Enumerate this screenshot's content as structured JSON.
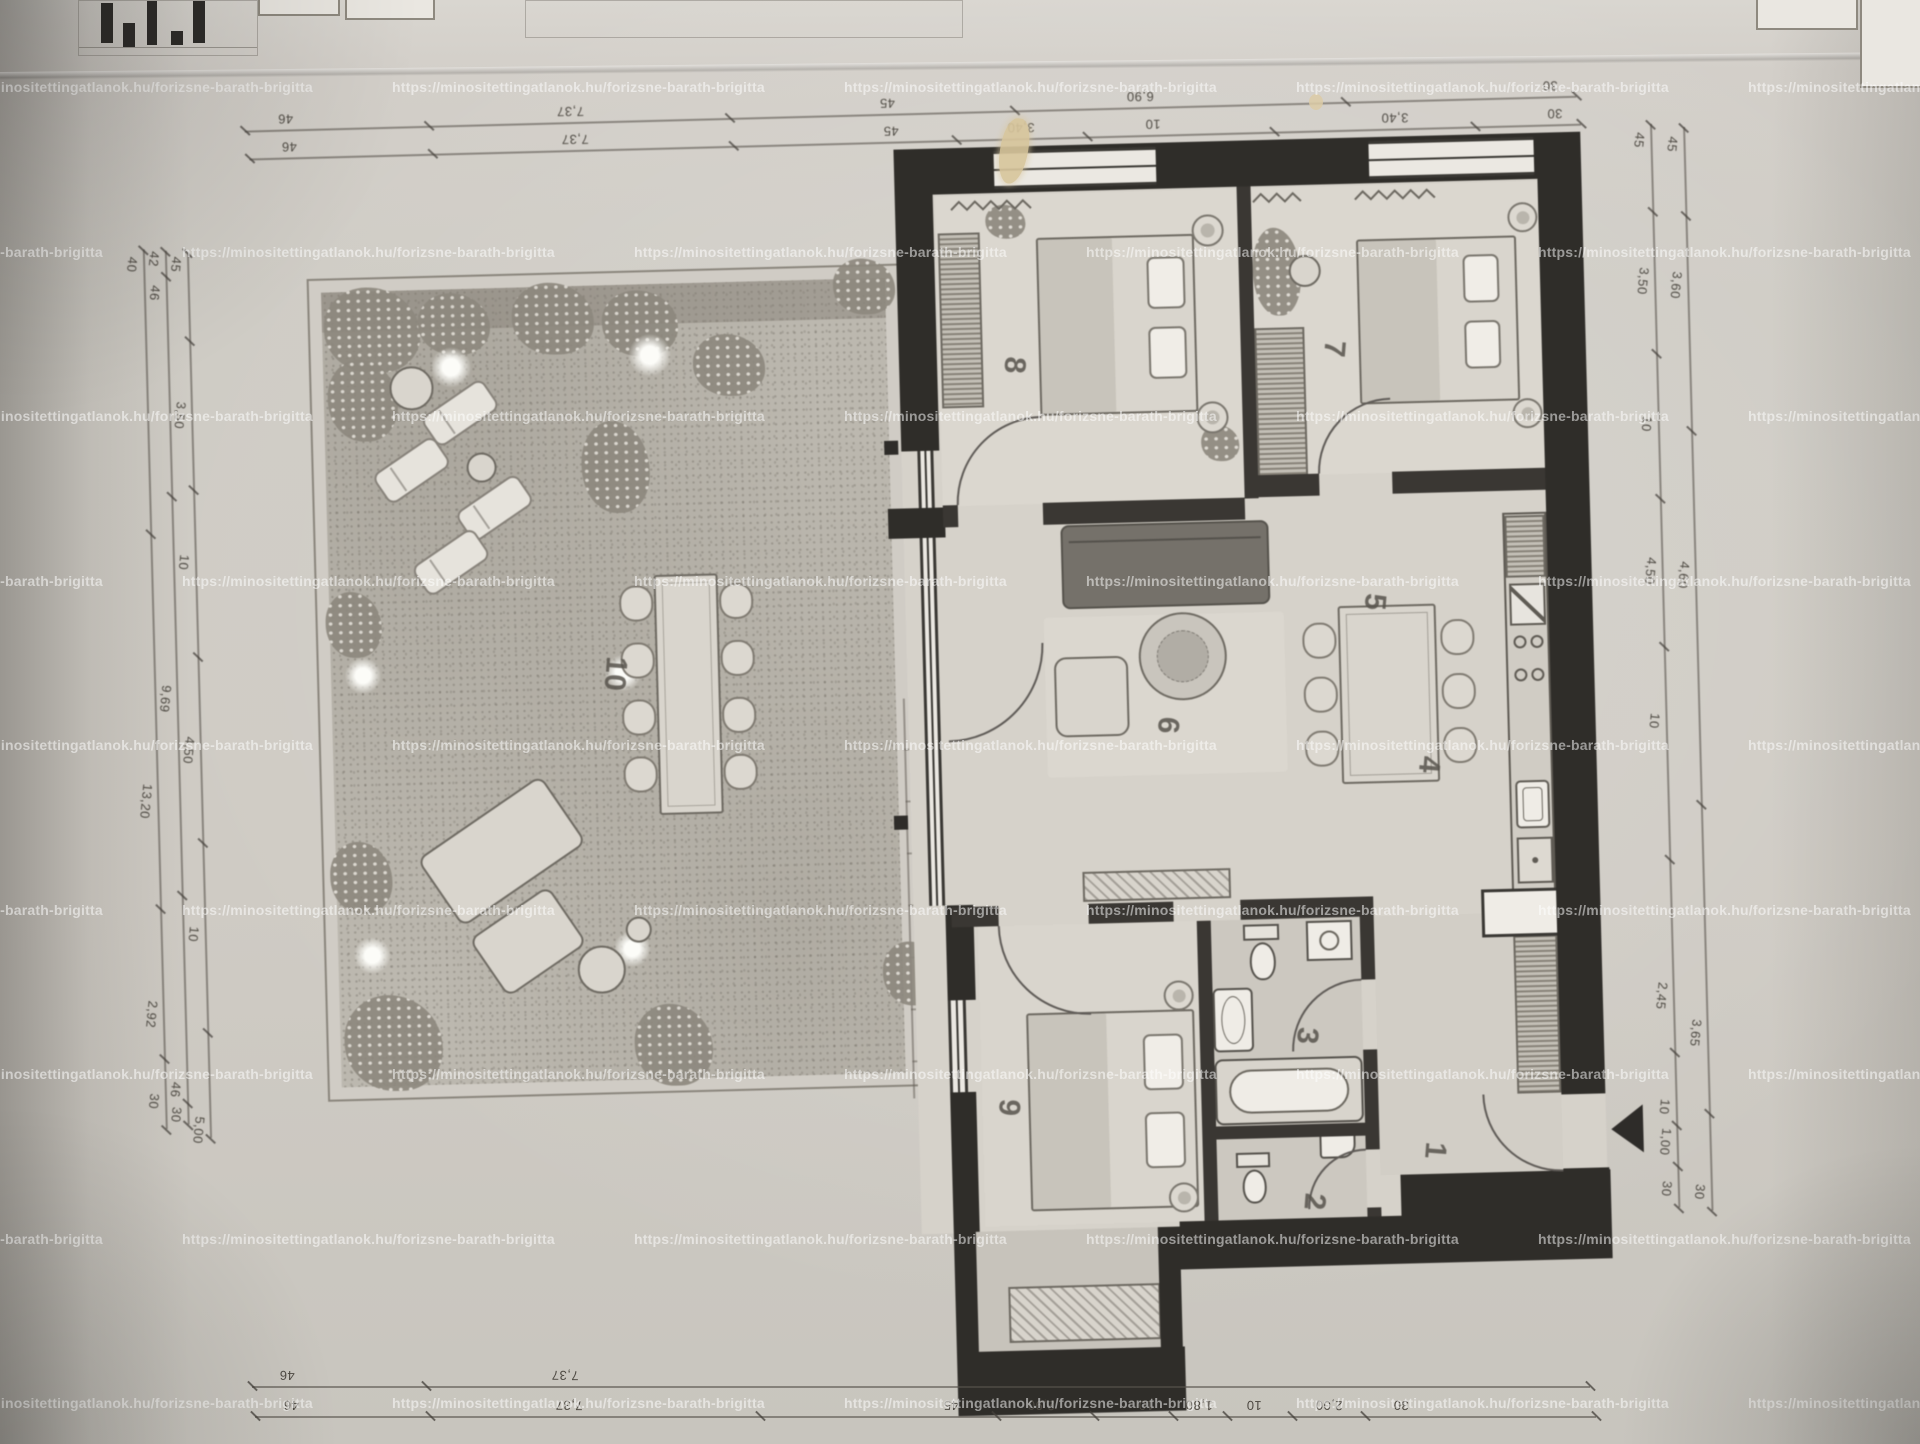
{
  "watermark": {
    "text": "https://minositettingatlanok.hu/forizsne-barath-brigitta"
  },
  "rooms": [
    {
      "label": "1",
      "x": 1406,
      "y": 1146
    },
    {
      "label": "2",
      "x": 1284,
      "y": 1194
    },
    {
      "label": "3",
      "x": 1281,
      "y": 1028
    },
    {
      "label": "4",
      "x": 1410,
      "y": 760
    },
    {
      "label": "5",
      "x": 1360,
      "y": 596
    },
    {
      "label": "6",
      "x": 1150,
      "y": 714
    },
    {
      "label": "7",
      "x": 1326,
      "y": 342
    },
    {
      "label": "8",
      "x": 1006,
      "y": 350
    },
    {
      "label": "9",
      "x": 981,
      "y": 1092
    },
    {
      "label": "10",
      "x": 590,
      "y": 648
    }
  ],
  "dims": {
    "chains": [
      {
        "name": "top-outer",
        "dir": "h",
        "flat": false,
        "pos": 112,
        "from": 252,
        "to": 1584,
        "labels": [
          {
            "t": "46",
            "at": 293
          },
          {
            "t": "7,37",
            "at": 578
          },
          {
            "t": "45",
            "at": 895
          },
          {
            "t": "6,90",
            "at": 1148
          },
          {
            "t": "30",
            "at": 1558
          }
        ]
      },
      {
        "name": "top-inner",
        "dir": "h",
        "flat": false,
        "pos": 140,
        "from": 256,
        "to": 1588,
        "labels": [
          {
            "t": "46",
            "at": 296
          },
          {
            "t": "7,37",
            "at": 582
          },
          {
            "t": "45",
            "at": 898
          },
          {
            "t": "3,40",
            "at": 1028
          },
          {
            "t": "10",
            "at": 1160
          },
          {
            "t": "3,40",
            "at": 1402
          },
          {
            "t": "30",
            "at": 1562
          }
        ]
      },
      {
        "name": "bottom-outer",
        "dir": "h",
        "flat": true,
        "pos": 1386,
        "from": 252,
        "to": 1590,
        "labels": [
          {
            "t": "46",
            "at": 287
          },
          {
            "t": "7,37",
            "at": 565
          }
        ]
      },
      {
        "name": "bottom-inner",
        "dir": "h",
        "flat": true,
        "pos": 1416,
        "from": 255,
        "to": 1596,
        "labels": [
          {
            "t": "46",
            "at": 291
          },
          {
            "t": "7,37",
            "at": 569
          },
          {
            "t": "45",
            "at": 951
          },
          {
            "t": "2,90",
            "at": 1041
          },
          {
            "t": "10",
            "at": 1146
          },
          {
            "t": "1,80",
            "at": 1199
          },
          {
            "t": "10",
            "at": 1254
          },
          {
            "t": "2,00",
            "at": 1329
          },
          {
            "t": "30",
            "at": 1401
          }
        ]
      },
      {
        "name": "left-outer",
        "dir": "v",
        "flat": false,
        "pos": 147,
        "from": 228,
        "to": 1108,
        "labels": [
          {
            "t": "40",
            "at": 243
          },
          {
            "t": "13,20",
            "at": 780
          },
          {
            "t": "2,92",
            "at": 993
          },
          {
            "t": "30",
            "at": 1080
          }
        ]
      },
      {
        "name": "left-middle",
        "dir": "v",
        "flat": false,
        "pos": 169,
        "from": 230,
        "to": 1104,
        "labels": [
          {
            "t": "42",
            "at": 238
          },
          {
            "t": "46",
            "at": 272
          },
          {
            "t": "9,69",
            "at": 678
          },
          {
            "t": "46",
            "at": 1069
          },
          {
            "t": "30",
            "at": 1094
          }
        ]
      },
      {
        "name": "left-inner",
        "dir": "v",
        "flat": false,
        "pos": 191,
        "from": 232,
        "to": 1118,
        "labels": [
          {
            "t": "45",
            "at": 244
          },
          {
            "t": "3,50",
            "at": 395
          },
          {
            "t": "10",
            "at": 542
          },
          {
            "t": "4,50",
            "at": 730
          },
          {
            "t": "10",
            "at": 914
          },
          {
            "t": "5,00",
            "at": 1110
          }
        ]
      },
      {
        "name": "right-inner",
        "dir": "v",
        "flat": false,
        "pos": 1657,
        "from": 142,
        "to": 1226,
        "labels": [
          {
            "t": "45",
            "at": 158
          },
          {
            "t": "3,50",
            "at": 299
          },
          {
            "t": "10",
            "at": 442
          },
          {
            "t": "4,50",
            "at": 589
          },
          {
            "t": "10",
            "at": 739
          },
          {
            "t": "2,45",
            "at": 1014
          },
          {
            "t": "10",
            "at": 1125
          },
          {
            "t": "1,00",
            "at": 1160
          },
          {
            "t": "30",
            "at": 1207
          }
        ]
      },
      {
        "name": "right-outer",
        "dir": "v",
        "flat": false,
        "pos": 1690,
        "from": 146,
        "to": 1230,
        "labels": [
          {
            "t": "45",
            "at": 163
          },
          {
            "t": "3,60",
            "at": 304
          },
          {
            "t": "4,60",
            "at": 594
          },
          {
            "t": "3,65",
            "at": 1052
          },
          {
            "t": "30",
            "at": 1211
          }
        ]
      }
    ]
  }
}
